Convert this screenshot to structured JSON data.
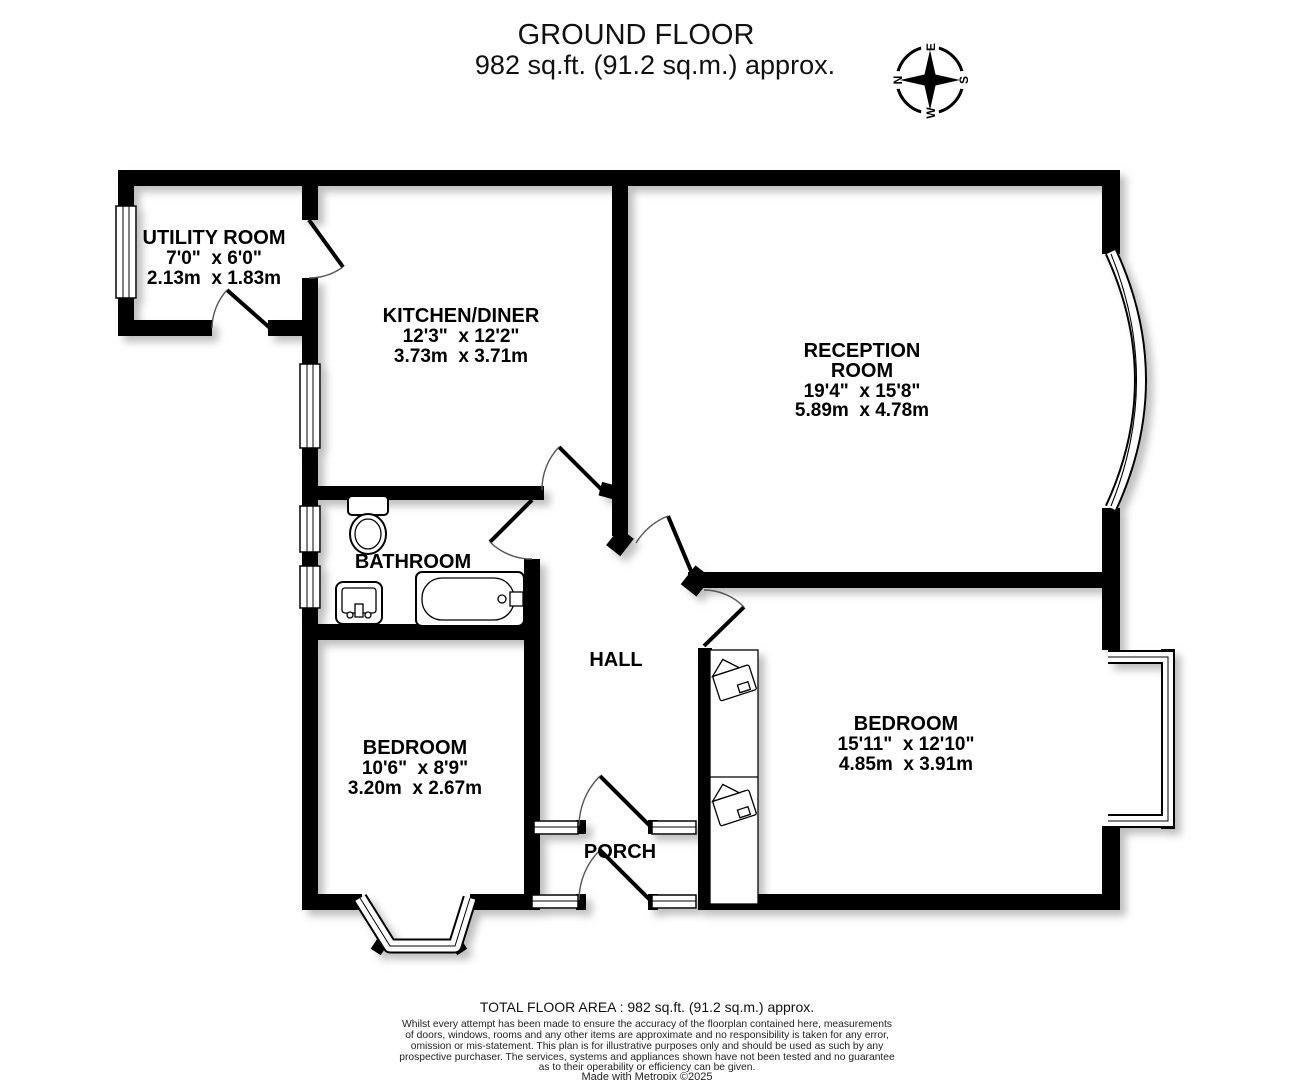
{
  "title": {
    "line1": "GROUND FLOOR",
    "line2": "982 sq.ft. (91.2 sq.m.) approx."
  },
  "compass": {
    "n": "N",
    "e": "E",
    "s": "S",
    "w": "W"
  },
  "rooms": {
    "utility": {
      "lines": [
        "UTILITY ROOM",
        "7'0\"  x 6'0\"",
        "2.13m  x 1.83m"
      ]
    },
    "kitchen_diner": {
      "lines": [
        "KITCHEN/DINER",
        "12'3\"  x 12'2\"",
        "3.73m  x 3.71m"
      ]
    },
    "reception": {
      "lines": [
        "RECEPTION",
        "ROOM",
        "19'4\"  x 15'8\"",
        "5.89m  x 4.78m"
      ]
    },
    "bathroom": {
      "lines": [
        "BATHROOM"
      ]
    },
    "hall": {
      "lines": [
        "HALL"
      ]
    },
    "bedroom_front": {
      "lines": [
        "BEDROOM",
        "10'6\"  x 8'9\"",
        "3.20m  x 2.67m"
      ]
    },
    "bedroom_rear": {
      "lines": [
        "BEDROOM",
        "15'11\"  x 12'10\"",
        "4.85m  x 3.91m"
      ]
    },
    "porch": {
      "lines": [
        "PORCH"
      ]
    }
  },
  "footer": {
    "total_area": "TOTAL FLOOR AREA : 982 sq.ft. (91.2 sq.m.) approx.",
    "disclaimer_lines": [
      "Whilst every attempt has been made to ensure the accuracy of the floorplan contained here, measurements",
      "of doors, windows, rooms and any other items are approximate and no responsibility is taken for any error,",
      "omission or mis-statement. This plan is for illustrative purposes only and should be used as such by any",
      "prospective purchaser. The services, systems and appliances shown have not been tested and no guarantee",
      "as to their operability or efficiency can be given."
    ],
    "credit": "Made with Metropix ©2025"
  },
  "colors": {
    "wall": "#000000",
    "background": "#ffffff",
    "window_fill": "#ffffff",
    "shadow": "#8a8a8a",
    "text": "#000000"
  }
}
